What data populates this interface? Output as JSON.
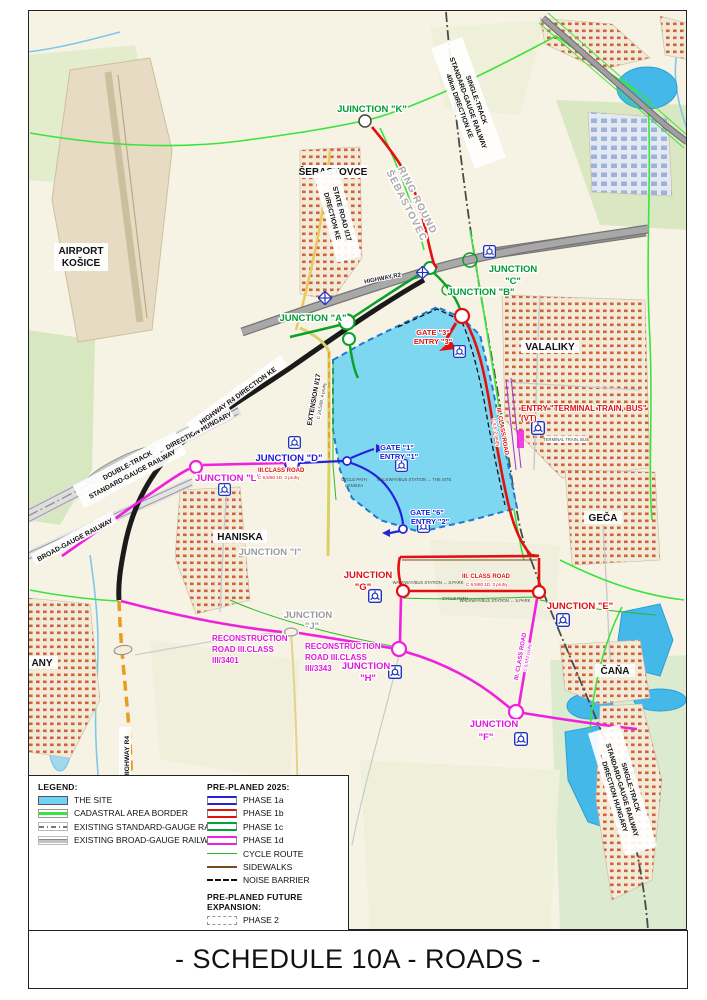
{
  "title": "- SCHEDULE 10A - ROADS -",
  "colors": {
    "site_fill": "#7ed7f0",
    "site_border": "#1f78d1",
    "phase_1a": "#2222dd",
    "phase_1b": "#e01111",
    "phase_1c": "#00a33a",
    "phase_1d": "#ee22dd",
    "cadastral": "#3ce33c",
    "cycle_route": "#2cb82c",
    "sidewalks": "#7a4a21",
    "noise_barrier": "#111111",
    "extension_orange": "#e89c20"
  },
  "legend": {
    "heading": "LEGEND:",
    "items": [
      {
        "label": "THE SITE"
      },
      {
        "label": "CADASTRAL AREA BORDER"
      },
      {
        "label": "EXISTING STANDARD-GAUGE RAILWAY"
      },
      {
        "label": "EXISTING BROAD-GAUGE RAILWAY"
      }
    ],
    "preplaned_heading": "PRE-PLANED 2025:",
    "preplaned_items": [
      {
        "label": "PHASE 1a",
        "color": "#2222dd"
      },
      {
        "label": "PHASE 1b",
        "color": "#e01111"
      },
      {
        "label": "PHASE 1c",
        "color": "#00a33a"
      },
      {
        "label": "PHASE 1d",
        "color": "#ee22dd"
      },
      {
        "label": "CYCLE ROUTE",
        "color": "#2cb82c"
      },
      {
        "label": "SIDEWALKS",
        "color": "#7a4a21"
      },
      {
        "label": "NOISE BARRIER",
        "color": "#111111"
      }
    ],
    "future_heading": "PRE-PLANED FUTURE EXPANSION:",
    "future_items": [
      {
        "label": "PHASE 2",
        "color": "#999999"
      }
    ]
  },
  "labels": {
    "junction_k": "JUINCTION \"K\"",
    "junction_a": "JUNCTION \"A\"",
    "junction_b": "JUNCTION \"B\"",
    "junction_c_1": "JUNCTION",
    "junction_c_2": "\"C\"",
    "junction_d": "JUNCTION \"D\"",
    "junction_e": "JUNCTION \"E\"",
    "junction_f_1": "JUNCTION",
    "junction_f_2": "\"F\"",
    "junction_g_1": "JUNCTION",
    "junction_g_2": "\"G\"",
    "junction_h_1": "JUNCTION",
    "junction_h_2": "\"H\"",
    "junction_i": "JUNCTION \"I\"",
    "junction_j_1": "JUNCTION",
    "junction_j_2": "\"J\"",
    "junction_l": "JUNCTION \"L\"",
    "gate3_1": "GATE \"3\"",
    "gate3_2": "ENTRY \"3\"",
    "gate1_1": "GATE \"1\"",
    "gate1_2": "ENTRY \"1\"",
    "gate6_1": "GATE \"6\"",
    "gate6_2": "ENTRY \"2\"",
    "entry_terminal_1": "ENTRY \"TERMINAL TRAIN, BUS\"",
    "entry_terminal_2": "(VT)",
    "terminal_small": "TERMINAL TRAIN, BUS",
    "airport_1": "AIRPORT",
    "airport_2": "KOŠICE",
    "sebastovce": "ŠEBASTOVCE",
    "valaliky": "VALALIKY",
    "haniska": "HANISKA",
    "geca": "GEČA",
    "cana": "ČAŇA",
    "any": "ANY",
    "highway_r2": "HIGHWAY R2",
    "highway_r4_ke": "HIGHWAY R4   DIRECTION KE",
    "direction_hungary_rail": "← DIRECTION HUNGARY",
    "double_track_1": "DOUBLE-TRACK",
    "double_track_2": "STANDARD-GAUGE RAILWAY",
    "broad_gauge": "BROAD-GAUGE RAILWAY",
    "single_track_ne_1": "SINGLE-TRACK",
    "single_track_ne_2": "STANDARD-GAUGE RAILWAY",
    "single_track_ne_3": "40km DIRECTION KE",
    "single_track_se_1": "SINGLE-TRACK",
    "single_track_se_2": "STANDARD-GAUGE RAILWAY",
    "single_track_se_3": "← DIRECTION HUNGARY",
    "state_road_1": "STATE ROAD I/17",
    "state_road_2": "DIRECTION KE",
    "ring_round_1": "RING ROUND",
    "ring_round_2": "ŠEBASTOVEC",
    "extension_i17": "EXTENSION I/17",
    "extension_i17_spec": "C 24,5/80, 4 pruhy",
    "highway_r4_vert": "HIGHWAY R4",
    "iii_class_road_d": "III.CLASS ROAD",
    "iii_class_road_d_spec": "C 9,5/80 1D, 3 pruhy",
    "iii_class_road_g": "III. CLASS ROAD",
    "iii_class_road_g_spec": "C 9,5/80 1D, 3 pruhy",
    "iii_class_road_e_1": "III. CLASS ROAD",
    "iii_class_road_e_2": "C 9,5, 2 pruhy",
    "iii_class_road_r_1": "III. CLASS ROAD",
    "iii_class_road_r_2": "C 9,5, 2 pruhy",
    "reconstruction1_1": "RECONSTRUCTION",
    "reconstruction1_2": "ROAD III.CLASS",
    "reconstruction1_3": "III/3401",
    "reconstruction2_1": "RECONSTRUCTION",
    "reconstruction2_2": "ROAD III.CLASS",
    "reconstruction2_3": "III/3343",
    "cycle_path_haniska_1": "CYCLE PATH",
    "cycle_path_haniska_2": "HANISKA",
    "cycle_path": "CYCLE PATH",
    "walkway_site": "WALKWAY/BUS STATION ↔ THE SITE",
    "walkway_spark_1": "WALKWAY/BUS STATION ↔ S.PARK",
    "walkway_spark_2": "WALKWAY/BUS STATION ↔ S.PARK"
  }
}
